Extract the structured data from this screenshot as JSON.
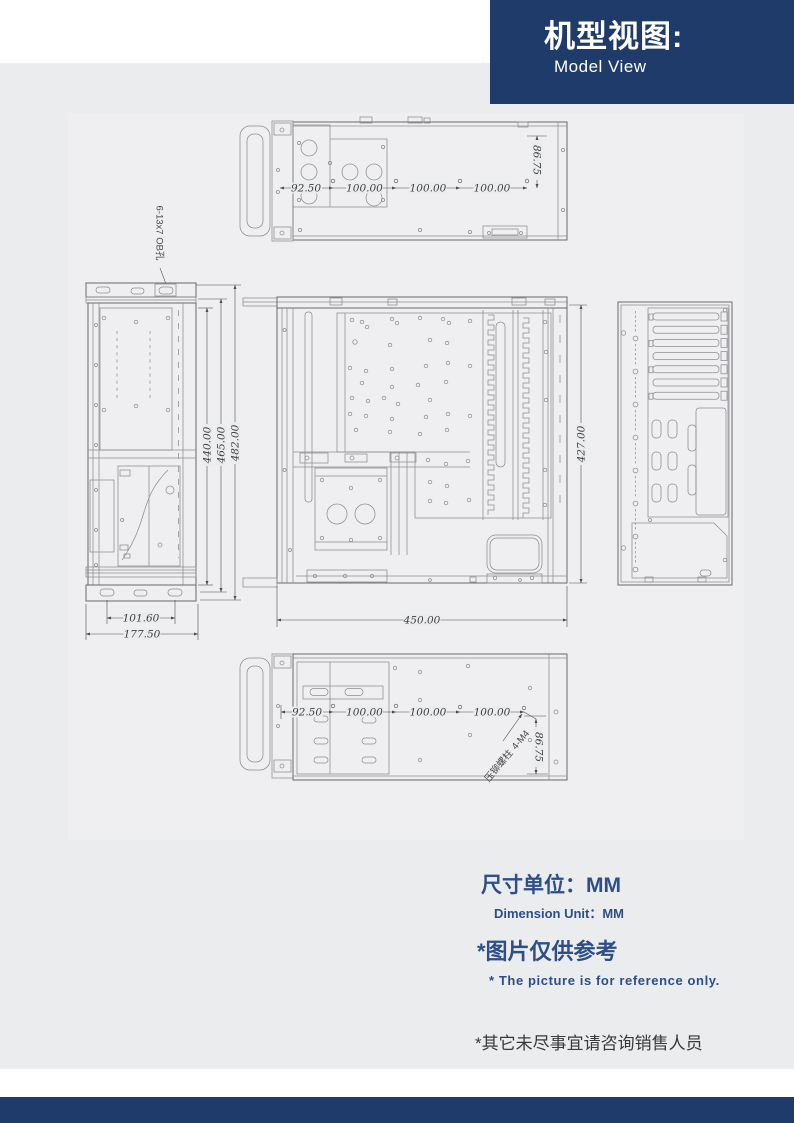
{
  "header": {
    "title_zh": "机型视图:",
    "title_en": "Model View"
  },
  "views": {
    "top": {
      "dim_seg1": "92.50",
      "dim_seg2": "100.00",
      "dim_seg3": "100.00",
      "dim_seg4": "100.00",
      "dim_height": "86.75"
    },
    "front": {
      "hole_note": "6-13x7 OB孔",
      "dim_h1": "440.00",
      "dim_h2": "465.00",
      "dim_h3": "482.00",
      "dim_inner_width": "101.60",
      "dim_outer_width": "177.50"
    },
    "side": {
      "dim_height": "427.00",
      "dim_depth": "450.00"
    },
    "bottom": {
      "dim_seg1": "92.50",
      "dim_seg2": "100.00",
      "dim_seg3": "100.00",
      "dim_seg4": "100.00",
      "dim_height": "86.75",
      "standoff_name": "压铆螺柱",
      "standoff_qty": "4-M4"
    }
  },
  "notes": {
    "unit_zh": "尺寸单位：MM",
    "unit_en": "Dimension Unit：MM",
    "ref_zh": "*图片仅供参考",
    "ref_en": "* The picture is for reference only.",
    "contact_zh": "*其它未尽事宜请咨询销售人员"
  },
  "colors": {
    "navy": "#1f3b6a",
    "note_blue": "#2d4e87",
    "background": "#ebeced",
    "line_gray": "#8c8d91"
  }
}
